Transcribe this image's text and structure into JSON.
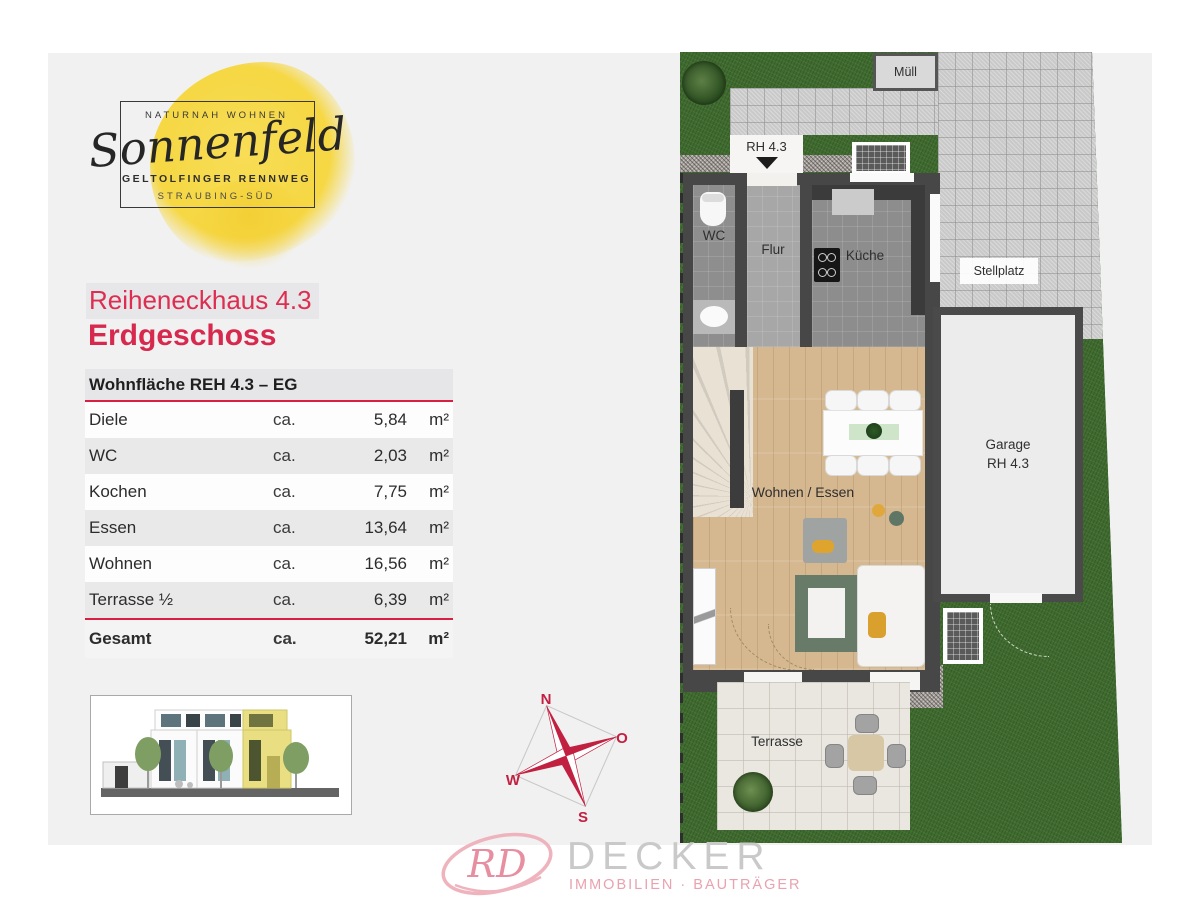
{
  "logo": {
    "tagline": "NATURNAH WOHNEN",
    "name": "Sonnenfeld",
    "line2": "GELTOLFINGER RENNWEG",
    "line3": "STRAUBING-SÜD"
  },
  "heading": {
    "subtitle": "Reiheneckhaus 4.3",
    "title": "Erdgeschoss"
  },
  "area_table": {
    "header": "Wohnfläche REH 4.3 – EG",
    "rows": [
      {
        "label": "Diele",
        "ca": "ca.",
        "value": "5,84",
        "unit": "m²"
      },
      {
        "label": "WC",
        "ca": "ca.",
        "value": "2,03",
        "unit": "m²"
      },
      {
        "label": "Kochen",
        "ca": "ca.",
        "value": "7,75",
        "unit": "m²"
      },
      {
        "label": "Essen",
        "ca": "ca.",
        "value": "13,64",
        "unit": "m²"
      },
      {
        "label": "Wohnen",
        "ca": "ca.",
        "value": "16,56",
        "unit": "m²"
      },
      {
        "label": "Terrasse ½",
        "ca": "ca.",
        "value": "6,39",
        "unit": "m²"
      }
    ],
    "total": {
      "label": "Gesamt",
      "ca": "ca.",
      "value": "52,21",
      "unit": "m²"
    }
  },
  "compass": {
    "n": "N",
    "o": "O",
    "w": "W",
    "s": "S"
  },
  "floor_plan": {
    "labels": {
      "muell": "Müll",
      "entrance": "RH 4.3",
      "wc": "WC",
      "flur": "Flur",
      "kueche": "Küche",
      "stellplatz": "Stellplatz",
      "garage_line1": "Garage",
      "garage_line2": "RH 4.3",
      "wohnen_essen": "Wohnen / Essen",
      "terrasse": "Terrasse"
    }
  },
  "footer": {
    "monogram": "RD",
    "company": "DECKER",
    "tagline": "IMMOBILIEN · BAUTRÄGER"
  },
  "colors": {
    "accent_red": "#dd2e51",
    "rule_red": "#d81f44",
    "compass_red": "#c22040",
    "logo_yellow": "#f5d63d",
    "footer_pink": "#e9a2af",
    "footer_gray": "#c9c9c9"
  }
}
